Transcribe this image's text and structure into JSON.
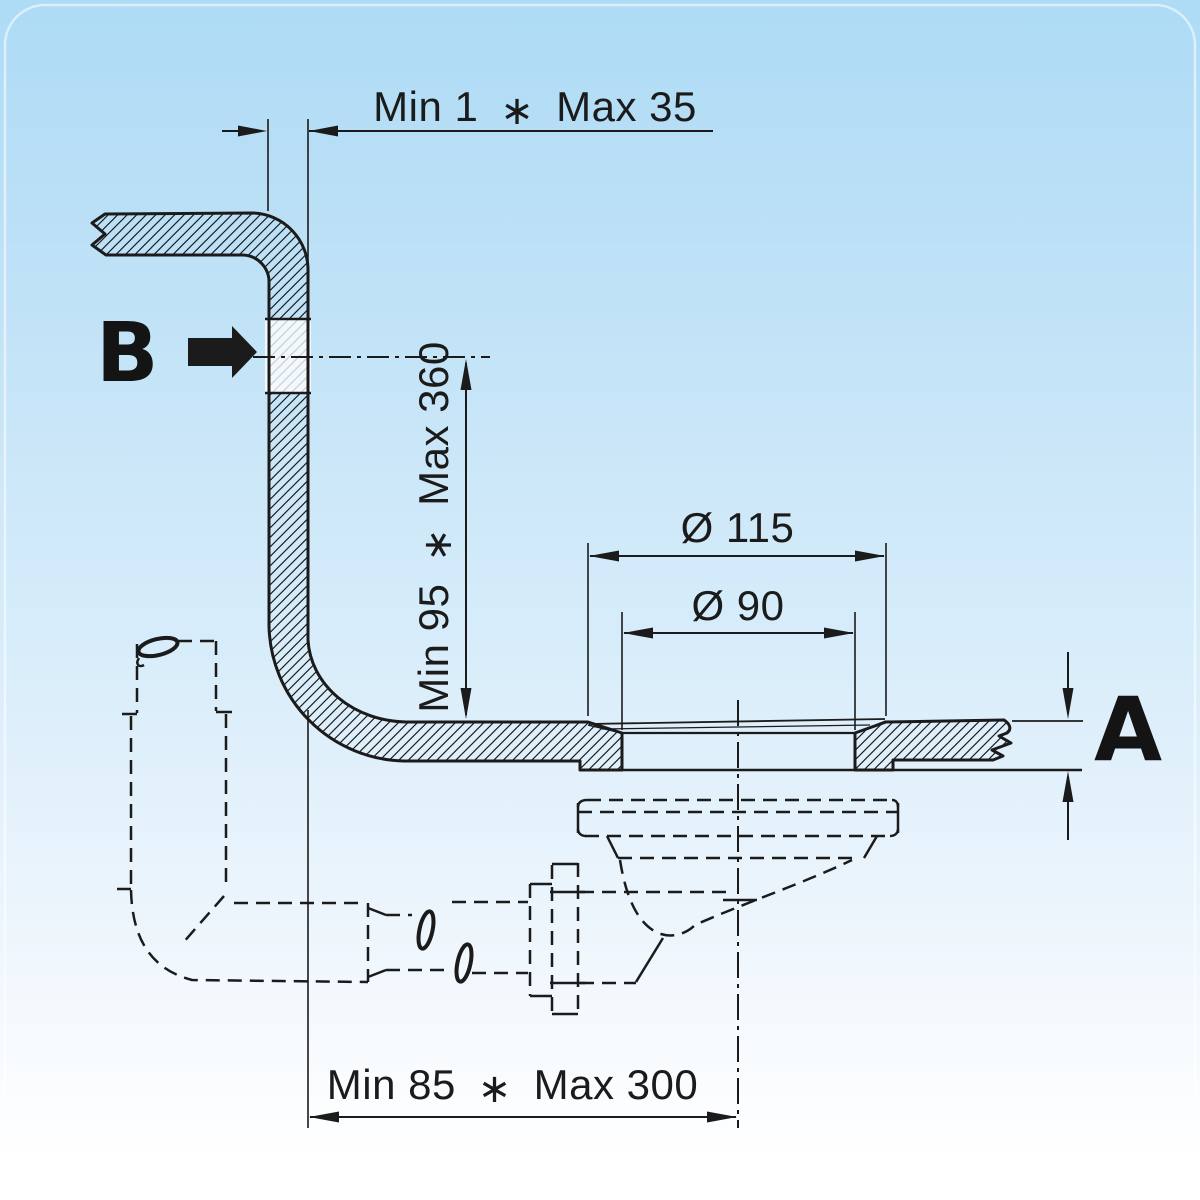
{
  "page": {
    "bg_top": "#aedbf5",
    "bg_mid": "#d6ecfa",
    "bg_bottom": "#ffffff",
    "line_color": "#1b1b1b"
  },
  "labels": {
    "overflow_connection": "B",
    "panel_thickness": "A"
  },
  "dimensions": {
    "wall_offset": {
      "min": "Min 1",
      "sep": "∗",
      "max": "Max 35"
    },
    "overflow_height": {
      "min": "Min 95",
      "sep": "∗",
      "max": "Max 360"
    },
    "flange_diameter": "Ø 115",
    "hole_diameter": "Ø 90",
    "horizontal_run": {
      "min": "Min 85",
      "sep": "∗",
      "max": "Max 300"
    }
  }
}
